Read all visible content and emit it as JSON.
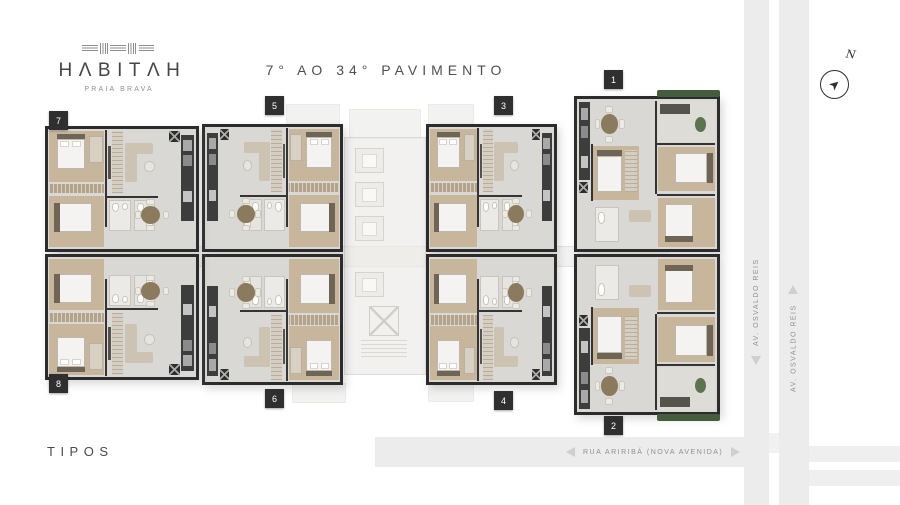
{
  "brand": {
    "logo_text": "HΛBITΛH",
    "tagline": "PRAIA BRAVA"
  },
  "title": "7° AO 34° PAVIMENTO",
  "footer_label": "TIPOS",
  "compass_north": "N",
  "streets": {
    "avenue_lane_out": "AV. OSVALDO REIS",
    "avenue_lane_in": "AV. OSVALDO REIS",
    "street_bottom": "RUA ARIRIBÁ (NOVA AVENIDA)"
  },
  "colors": {
    "wall": "#2c2c2c",
    "floor": "#d9d8d5",
    "wood": "#c7b59c",
    "tag_bg": "#2f2f2f",
    "road": "#ececec",
    "text": "#4b4b4b",
    "hedge": "#465c3e"
  },
  "units": [
    {
      "number": "1",
      "type": "large",
      "x": 574,
      "y": 96,
      "w": 146,
      "h": 156,
      "flipX": false,
      "flipY": false,
      "tag": {
        "x": 604,
        "y": 70
      }
    },
    {
      "number": "2",
      "type": "large",
      "x": 574,
      "y": 254,
      "w": 146,
      "h": 161,
      "flipX": false,
      "flipY": true,
      "tag": {
        "x": 604,
        "y": 416
      }
    },
    {
      "number": "3",
      "type": "std",
      "x": 426,
      "y": 124,
      "w": 131,
      "h": 128,
      "flipX": false,
      "flipY": false,
      "tag": {
        "x": 494,
        "y": 96
      }
    },
    {
      "number": "4",
      "type": "std",
      "x": 426,
      "y": 254,
      "w": 131,
      "h": 131,
      "flipX": false,
      "flipY": true,
      "tag": {
        "x": 494,
        "y": 391
      }
    },
    {
      "number": "5",
      "type": "std",
      "x": 202,
      "y": 124,
      "w": 141,
      "h": 128,
      "flipX": true,
      "flipY": false,
      "tag": {
        "x": 265,
        "y": 96
      }
    },
    {
      "number": "6",
      "type": "std",
      "x": 202,
      "y": 254,
      "w": 141,
      "h": 131,
      "flipX": true,
      "flipY": true,
      "tag": {
        "x": 265,
        "y": 389
      }
    },
    {
      "number": "7",
      "type": "std",
      "x": 45,
      "y": 126,
      "w": 154,
      "h": 126,
      "flipX": false,
      "flipY": false,
      "tag": {
        "x": 49,
        "y": 111
      }
    },
    {
      "number": "8",
      "type": "std",
      "x": 45,
      "y": 254,
      "w": 154,
      "h": 126,
      "flipX": false,
      "flipY": true,
      "tag": {
        "x": 49,
        "y": 374
      }
    }
  ]
}
